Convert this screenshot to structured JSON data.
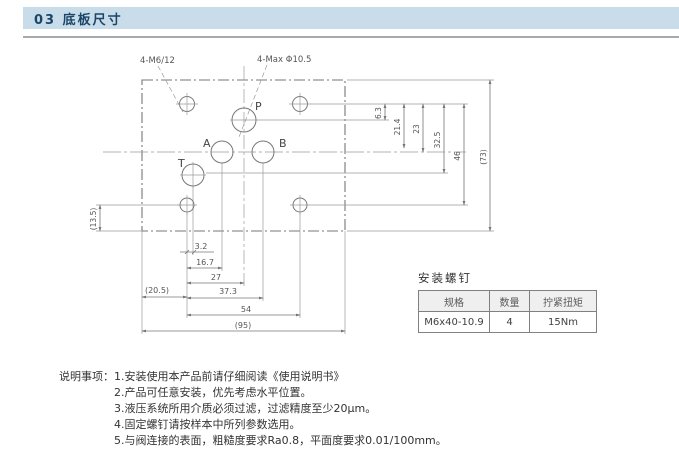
{
  "header": {
    "title": "03 底板尺寸"
  },
  "colors": {
    "titlebar_bg": "#c9dcea",
    "titlebar_text": "#1c4668",
    "drawing_line": "#7d7d7d",
    "dim_text": "#555555"
  },
  "drawing": {
    "callouts": {
      "mounting_thread": "4-M6/12",
      "max_port": "4-Max Φ10.5"
    },
    "ports": {
      "p": "P",
      "a": "A",
      "b": "B",
      "t": "T"
    },
    "dims": {
      "d_3_2": "3.2",
      "d_16_7": "16.7",
      "d_27": "27",
      "d_20_5": "(20.5)",
      "d_37_3": "37.3",
      "d_54": "54",
      "d_95": "(95)",
      "d_6_3": "6.3",
      "d_21_4": "21.4",
      "d_23": "23",
      "d_32_5": "32.5",
      "d_46": "46",
      "d_73": "(73)",
      "d_13_5": "(13.5)"
    }
  },
  "screw_table": {
    "title": "安装螺钉",
    "headers": [
      "规格",
      "数量",
      "拧紧扭矩"
    ],
    "row": [
      "M6x40-10.9",
      "4",
      "15Nm"
    ]
  },
  "notes": {
    "label": "说明事项：",
    "items": [
      "1.安装使用本产品前请仔细阅读《使用说明书》",
      "2.产品可任意安装，优先考虑水平位置。",
      "3.液压系统所用介质必须过滤，过滤精度至少20μm。",
      "4.固定螺钉请按样本中所列参数选用。",
      "5.与阀连接的表面，粗糙度要求Ra0.8，平面度要求0.01/100mm。"
    ]
  }
}
